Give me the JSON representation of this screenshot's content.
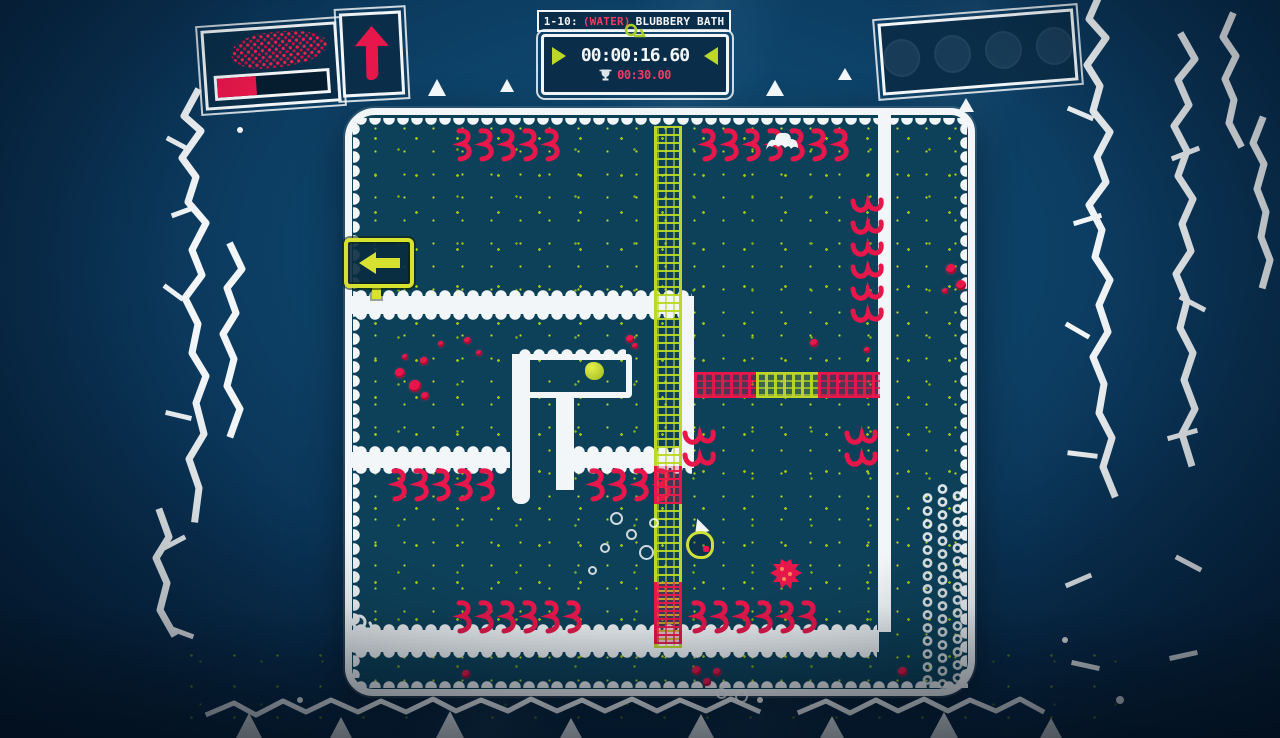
{
  "colors": {
    "red": "#e8174b",
    "pink": "#f23b63",
    "green": "#bdd62a",
    "white": "#f2f6f8",
    "panel": "#0a2e49",
    "water": "#0d4159"
  },
  "header": {
    "level_number": "1-10:",
    "world_tag": "(WATER)",
    "level_name": "BLUBBERY BATH"
  },
  "timer": {
    "current": "00:00:16.60",
    "target": "00:30.00"
  },
  "meters": {
    "fill_percent": 35
  },
  "inventory": {
    "slot_count": 4
  },
  "icons": {
    "mascot": "snail-icon",
    "best_time": "trophy-icon",
    "timer_prev": "prev-triangle-icon",
    "timer_next": "next-triangle-icon",
    "boost": "up-arrow-icon",
    "sign": "left-arrow-sign-icon",
    "hazard": "red-squiggle-spikes",
    "collectible": "berry"
  }
}
